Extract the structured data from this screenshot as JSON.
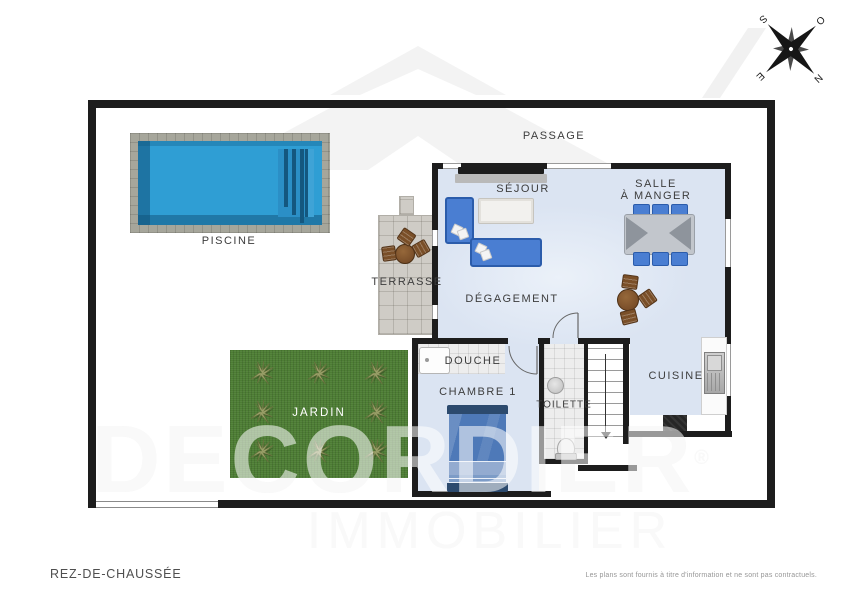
{
  "rooms": {
    "passage": "PASSAGE",
    "piscine": "PISCINE",
    "sejour": "SÉJOUR",
    "salle_a_manger_line1": "SALLE",
    "salle_a_manger_line2": "À MANGER",
    "terrasse": "TERRASSE",
    "degagement": "DÉGAGEMENT",
    "jardin": "JARDIN",
    "douche": "DOUCHE",
    "chambre1": "CHAMBRE 1",
    "toilette": "TOILETTE",
    "cuisine": "CUISINE"
  },
  "compass": {
    "n": "N",
    "s": "S",
    "e": "E",
    "o": "O"
  },
  "watermark": {
    "brand": "DECORDIER",
    "reg": "®",
    "tagline": "IMMOBILIER"
  },
  "footer": {
    "floor_label": "REZ-DE-CHAUSSÉE",
    "disclaimer": "Les plans sont fournis à titre d'information et ne sont pas contractuels."
  },
  "colors": {
    "wall": "#1d1d1d",
    "floor": "#dbe4f2",
    "pool_water": "#2f9ed4",
    "grass": "#4d7d34",
    "sofa_blue": "#4a7ed2",
    "wood_brown": "#7a4f28",
    "watermark_gray": "#f1f1f1"
  }
}
